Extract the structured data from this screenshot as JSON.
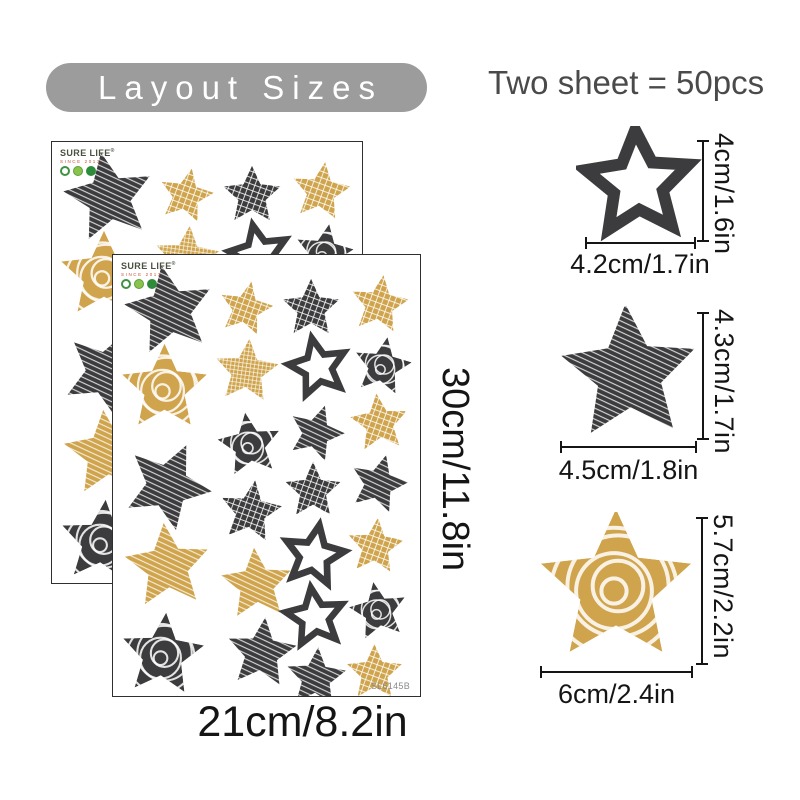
{
  "title_banner": "Layout Sizes",
  "header_note": "Two sheet = 50pcs",
  "colors": {
    "dark": "#3c3c3e",
    "gold": "#cfa44c",
    "banner_bg": "#9c9c9c",
    "banner_text": "#ffffff",
    "note_text": "#4a4a4a",
    "dim_text": "#151515"
  },
  "sheet": {
    "brand": "SURE LIFE",
    "brand_reg": "®",
    "brand_since": "SINCE 2013",
    "sku": "SL6145B",
    "width_label": "21cm/8.2in",
    "height_label": "30cm/11.8in",
    "star_fields": [
      "x",
      "y",
      "outer_radius",
      "color",
      "texture",
      "rotation_deg"
    ],
    "stars": [
      [
        57,
        56,
        46,
        "dark",
        "streak",
        -10
      ],
      [
        52,
        134,
        45,
        "gold",
        "swirl",
        0
      ],
      [
        55,
        232,
        45,
        "dark",
        "streak",
        25
      ],
      [
        55,
        313,
        44,
        "gold",
        "streak",
        -5
      ],
      [
        50,
        402,
        43,
        "dark",
        "swirl",
        5
      ],
      [
        134,
        54,
        28,
        "gold",
        "hatch",
        12
      ],
      [
        135,
        117,
        33,
        "gold",
        "grid",
        5
      ],
      [
        138,
        191,
        33,
        "dark",
        "swirl",
        -8
      ],
      [
        139,
        258,
        32,
        "dark",
        "hatch",
        8
      ],
      [
        145,
        331,
        37,
        "gold",
        "streak",
        -4
      ],
      [
        150,
        400,
        36,
        "dark",
        "streak",
        6
      ],
      [
        200,
        54,
        30,
        "dark",
        "hatch",
        0
      ],
      [
        207,
        113,
        30,
        "dark",
        "outline",
        -12
      ],
      [
        205,
        179,
        29,
        "dark",
        "streak",
        18
      ],
      [
        202,
        237,
        29,
        "dark",
        "hatch",
        0
      ],
      [
        203,
        302,
        31,
        "dark",
        "outline",
        10
      ],
      [
        204,
        364,
        30,
        "dark",
        "outline",
        -8
      ],
      [
        205,
        425,
        31,
        "dark",
        "streak",
        4
      ],
      [
        269,
        50,
        30,
        "gold",
        "hatch",
        8
      ],
      [
        272,
        112,
        30,
        "dark",
        "swirl",
        10
      ],
      [
        269,
        169,
        30,
        "gold",
        "hatch",
        -6
      ],
      [
        268,
        230,
        30,
        "dark",
        "streak",
        15
      ],
      [
        265,
        293,
        29,
        "gold",
        "hatch",
        5
      ],
      [
        268,
        358,
        30,
        "dark",
        "swirl",
        -10
      ],
      [
        264,
        420,
        29,
        "gold",
        "hatch",
        0
      ]
    ]
  },
  "size_samples": [
    {
      "name": "small-star",
      "height_label": "4cm/1.6in",
      "width_label": "4.2cm/1.7in",
      "color": "dark",
      "texture": "outline"
    },
    {
      "name": "medium-star",
      "height_label": "4.3cm/1.7in",
      "width_label": "4.5cm/1.8in",
      "color": "dark",
      "texture": "streak"
    },
    {
      "name": "large-star",
      "height_label": "5.7cm/2.2in",
      "width_label": "6cm/2.4in",
      "color": "gold",
      "texture": "swirl"
    }
  ]
}
